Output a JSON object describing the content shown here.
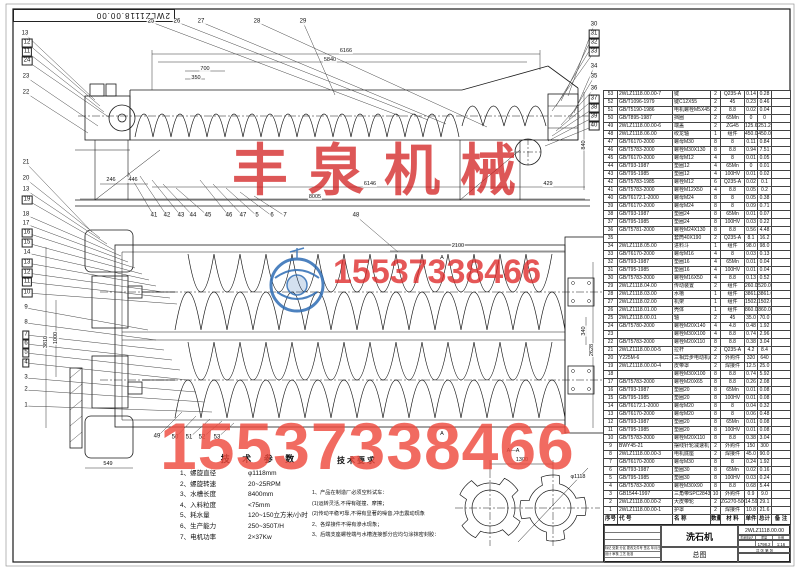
{
  "sheet": {
    "corner_drawing_no": "2WLZ1118.00.00"
  },
  "watermarks": {
    "company": "丰泉机械",
    "phone_mid": "15537338466",
    "phone_large": "15537338466"
  },
  "tech_params": {
    "title": "技 术 参 数",
    "items": [
      [
        "1、螺旋直径",
        "φ1118mm"
      ],
      [
        "2、螺旋转速",
        "20~25RPM"
      ],
      [
        "3、水槽长度",
        "8400mm"
      ],
      [
        "4、入料粒度",
        "<75mm"
      ],
      [
        "5、耗水量",
        "120~150立方米/小时"
      ],
      [
        "6、生产能力",
        "250~350T/H"
      ],
      [
        "7、电机功率",
        "2×37Kw"
      ]
    ]
  },
  "tech_req": {
    "title": "技术要求",
    "lines": [
      "1、产品在制造厂必须空料试车：",
      "(1)运转灵活,不得有碰撞、摩擦；",
      "(2)传动平稳可靠,不得有显著的噪音,冲击震动现象",
      "2、各焊接件不得有渗水现象；",
      "3、后端支座螺栓端与水槽连接部分应均匀涂抹密封胶："
    ]
  },
  "bom": {
    "headers": [
      "序号",
      "代 号",
      "名 称",
      "数量",
      "材 料",
      "单件",
      "总计",
      "备 注"
    ],
    "rows": [
      [
        "53",
        "2WLZ1118.00.00-7",
        "键",
        "2",
        "Q235-A",
        "0.14",
        "0.28",
        ""
      ],
      [
        "52",
        "GB/T1096-1979",
        "键C12X55",
        "2",
        "45",
        "0.23",
        "0.46",
        ""
      ],
      [
        "51",
        "GB/T5190-1986",
        "电机螺栓M5X45",
        "2",
        "8.8",
        "0.02",
        "0.04",
        ""
      ],
      [
        "50",
        "GB/T895-1987",
        "挡圈",
        "2",
        "65Mn",
        "0",
        "0",
        ""
      ],
      [
        "49",
        "2WLZ1118.00.00-6",
        "端盖",
        "2",
        "ZG45",
        "125.6",
        "251.2",
        ""
      ],
      [
        "48",
        "2WLZ1118.06.00",
        "绞龙轴",
        "1",
        "组件",
        "450.0",
        "450.0",
        ""
      ],
      [
        "47",
        "GB/T6170-2000",
        "螺母M30",
        "8",
        "8",
        "0.11",
        "0.84",
        ""
      ],
      [
        "46",
        "GB/T5783-2000",
        "螺栓M30X130",
        "8",
        "8.8",
        "0.94",
        "7.51",
        ""
      ],
      [
        "45",
        "GB/T6170-2000",
        "螺母M12",
        "4",
        "8",
        "0.01",
        "0.05",
        ""
      ],
      [
        "44",
        "GB/T93-1987",
        "垫圈12",
        "4",
        "65Mn",
        "0",
        "0.01",
        ""
      ],
      [
        "43",
        "GB/T95-1985",
        "垫圈12",
        "4",
        "100HV",
        "0.01",
        "0.02",
        ""
      ],
      [
        "42",
        "GB/T5783-1985",
        "螺栓M12",
        "6",
        "Q235-A",
        "0.02",
        "0.1",
        ""
      ],
      [
        "41",
        "GB/T5783-2000",
        "螺栓M12X50",
        "4",
        "8.8",
        "0.05",
        "0.2",
        ""
      ],
      [
        "40",
        "GB/T6172.1-2000",
        "螺母M24",
        "8",
        "8",
        "0.05",
        "0.38",
        ""
      ],
      [
        "39",
        "GB/T6170-2000",
        "螺母M24",
        "8",
        "8",
        "0.09",
        "0.71",
        ""
      ],
      [
        "38",
        "GB/T93-1987",
        "垫圈24",
        "8",
        "65Mn",
        "0.01",
        "0.07",
        ""
      ],
      [
        "37",
        "GB/T95-1985",
        "垫圈24",
        "8",
        "100HV",
        "0.03",
        "0.22",
        ""
      ],
      [
        "36",
        "GB/T5781-2000",
        "螺栓M24X130",
        "8",
        "8.8",
        "0.56",
        "4.48",
        ""
      ],
      [
        "35",
        "",
        "套筒40X190",
        "2",
        "Q235-A",
        "8.1",
        "16.2",
        ""
      ],
      [
        "34",
        "2WLZ1118.05.00",
        "进料斗",
        "1",
        "组件",
        "98.0",
        "98.0",
        ""
      ],
      [
        "33",
        "GB/T6170-2000",
        "螺母M16",
        "4",
        "8",
        "0.03",
        "0.13",
        ""
      ],
      [
        "32",
        "GB/T93-1987",
        "垫圈16",
        "4",
        "65Mn",
        "0.01",
        "0.04",
        ""
      ],
      [
        "31",
        "GB/T95-1985",
        "垫圈16",
        "4",
        "100HV",
        "0.01",
        "0.04",
        ""
      ],
      [
        "30",
        "GB/T5783-2000",
        "螺栓M16X50",
        "4",
        "8.8",
        "0.13",
        "0.52",
        ""
      ],
      [
        "29",
        "2WLZ1118.04.00",
        "传动装置",
        "2",
        "组件",
        "260.0",
        "520.0",
        ""
      ],
      [
        "28",
        "2WLZ1118.03.00",
        "水槽",
        "1",
        "组件",
        "3861.0",
        "3861.0",
        ""
      ],
      [
        "27",
        "2WLZ1118.02.00",
        "机架",
        "1",
        "组件",
        "1502.0",
        "1502.0",
        ""
      ],
      [
        "26",
        "2WLZ1118.01.00",
        "壳体",
        "1",
        "组件",
        "860.0",
        "860.0",
        ""
      ],
      [
        "25",
        "2WLZ1118.00.01",
        "轴",
        "2",
        "45",
        "35.0",
        "70.0",
        ""
      ],
      [
        "24",
        "GB/T5780-2000",
        "螺栓M20X140",
        "4",
        "4.8",
        "0.48",
        "1.92",
        ""
      ],
      [
        "23",
        "",
        "螺栓M30X100",
        "4",
        "8.8",
        "0.74",
        "2.96",
        ""
      ],
      [
        "22",
        "GB/T5783-2000",
        "螺栓M20X110",
        "8",
        "8.8",
        "0.38",
        "3.04",
        ""
      ],
      [
        "21",
        "2WLZ1118.00.00-5",
        "拉杆",
        "2",
        "Q235-A",
        "4.2",
        "8.4",
        ""
      ],
      [
        "20",
        "Y225M-6",
        "三相异步电动机/37KW",
        "2",
        "外购件",
        "320",
        "640",
        ""
      ],
      [
        "19",
        "2WLZ1118.00.00-4",
        "皮带罩",
        "2",
        "焊接件",
        "12.5",
        "25.0",
        ""
      ],
      [
        "18",
        "",
        "螺栓M30X100",
        "8",
        "8.8",
        "0.74",
        "5.92",
        ""
      ],
      [
        "17",
        "GB/T5783-2000",
        "螺栓M20X65",
        "8",
        "8.8",
        "0.26",
        "2.08",
        ""
      ],
      [
        "16",
        "GB/T93-1987",
        "垫圈20",
        "8",
        "65Mn",
        "0.01",
        "0.08",
        ""
      ],
      [
        "15",
        "GB/T95-1985",
        "垫圈20",
        "8",
        "100HV",
        "0.01",
        "0.08",
        ""
      ],
      [
        "14",
        "GB/T6172.1-2000",
        "螺母M20",
        "8",
        "8",
        "0.04",
        "0.32",
        ""
      ],
      [
        "13",
        "GB/T6170-2000",
        "螺母M20",
        "8",
        "8",
        "0.06",
        "0.48",
        ""
      ],
      [
        "12",
        "GB/T93-1987",
        "垫圈20",
        "8",
        "65Mn",
        "0.01",
        "0.08",
        ""
      ],
      [
        "11",
        "GB/T95-1985",
        "垫圈20",
        "8",
        "100HV",
        "0.01",
        "0.08",
        ""
      ],
      [
        "10",
        "GB/T5783-2000",
        "螺栓M20X110",
        "8",
        "8.8",
        "0.38",
        "3.04",
        ""
      ],
      [
        "9",
        "BWY45-21",
        "摆线针轮减速机",
        "2",
        "外购件",
        "150",
        "300",
        ""
      ],
      [
        "8",
        "2WLZ1118.00.00-3",
        "电机底座",
        "2",
        "焊接件",
        "45.0",
        "90.0",
        ""
      ],
      [
        "7",
        "GB/T6170-2000",
        "螺母M30",
        "8",
        "8",
        "0.24",
        "1.92",
        ""
      ],
      [
        "6",
        "GB/T93-1987",
        "垫圈30",
        "8",
        "65Mn",
        "0.02",
        "0.16",
        ""
      ],
      [
        "5",
        "GB/T95-1985",
        "垫圈30",
        "8",
        "100HV",
        "0.03",
        "0.24",
        ""
      ],
      [
        "4",
        "GB/T5783-2000",
        "螺栓M30X90",
        "8",
        "8.8",
        "0.68",
        "5.44",
        ""
      ],
      [
        "3",
        "GB1544-1997",
        "三角带SPC2843",
        "10",
        "外购件",
        "0.9",
        "9.0",
        ""
      ],
      [
        "2",
        "2WLZ1118.00.00-2",
        "大皮带轮",
        "2",
        "ZG270-500",
        "14.59",
        "29.1",
        ""
      ],
      [
        "1",
        "2WLZ1118.00.00-1",
        "护罩",
        "2",
        "焊接件",
        "10.8",
        "21.6",
        ""
      ]
    ]
  },
  "title_block": {
    "product_name": "洗石机",
    "drawing_no": "2WLZ1118.00.00",
    "view_type": "总图",
    "stage_label": "阶段标记",
    "weight_label": "重量",
    "scale_label": "比例",
    "weight_value": "1798.2",
    "scale_value": "1:16",
    "sheet_label": "共 张 第 张",
    "rev_header": "标记 处数 分区 更改文件号 签名 年月日",
    "sign_row": "设计  审核  工艺  批准"
  },
  "callouts": [
    [
      "13",
      25,
      34,
      0,
      95,
      100
    ],
    [
      "12",
      27,
      43,
      1,
      100,
      106
    ],
    [
      "11",
      27,
      52,
      1,
      104,
      112
    ],
    [
      "24",
      27,
      61,
      1,
      110,
      118
    ],
    [
      "23",
      26,
      77,
      0,
      98,
      126
    ],
    [
      "22",
      26,
      93,
      0,
      88,
      133
    ],
    [
      "25",
      151,
      22,
      0,
      400,
      116
    ],
    [
      "26",
      177,
      22,
      0,
      428,
      120
    ],
    [
      "27",
      201,
      22,
      0,
      446,
      124
    ],
    [
      "28",
      257,
      22,
      0,
      487,
      127
    ],
    [
      "29",
      303,
      22,
      0,
      335,
      95
    ],
    [
      "30",
      594,
      25,
      0,
      568,
      96
    ],
    [
      "31",
      594,
      34,
      1,
      561,
      101
    ],
    [
      "32",
      594,
      43,
      1,
      556,
      106
    ],
    [
      "33",
      594,
      52,
      1,
      552,
      111
    ],
    [
      "34",
      594,
      67,
      0,
      574,
      113
    ],
    [
      "35",
      594,
      77,
      0,
      569,
      119
    ],
    [
      "36",
      594,
      89,
      0,
      561,
      125
    ],
    [
      "37",
      594,
      99,
      1,
      556,
      131
    ],
    [
      "38",
      594,
      108,
      1,
      552,
      136
    ],
    [
      "39",
      594,
      117,
      1,
      548,
      141
    ],
    [
      "40",
      594,
      126,
      1,
      545,
      146
    ],
    [
      "41",
      154,
      216,
      0,
      128,
      172
    ],
    [
      "42",
      167,
      216,
      0,
      140,
      176
    ],
    [
      "43",
      181,
      216,
      0,
      152,
      180
    ],
    [
      "44",
      193,
      216,
      0,
      163,
      184
    ],
    [
      "45",
      208,
      216,
      0,
      176,
      188
    ],
    [
      "46",
      229,
      216,
      0,
      200,
      180
    ],
    [
      "47",
      243,
      216,
      0,
      213,
      184
    ],
    [
      "5",
      257,
      216,
      0,
      226,
      188
    ],
    [
      "6",
      272,
      216,
      0,
      240,
      192
    ],
    [
      "7",
      285,
      216,
      0,
      254,
      196
    ],
    [
      "48",
      356,
      216,
      0,
      398,
      252
    ],
    [
      "21",
      26,
      163,
      0,
      92,
      232
    ],
    [
      "20",
      26,
      179,
      0,
      100,
      238
    ],
    [
      "13",
      26,
      190,
      0,
      107,
      244
    ],
    [
      "19",
      27,
      200,
      1,
      114,
      250
    ],
    [
      "18",
      26,
      215,
      0,
      121,
      256
    ],
    [
      "17",
      26,
      224,
      0,
      128,
      262
    ],
    [
      "16",
      27,
      233,
      1,
      135,
      268
    ],
    [
      "15",
      27,
      243,
      1,
      142,
      274
    ],
    [
      "14",
      27,
      253,
      0,
      149,
      280
    ],
    [
      "13",
      27,
      263,
      1,
      156,
      286
    ],
    [
      "12",
      27,
      273,
      1,
      163,
      292
    ],
    [
      "11",
      27,
      282,
      1,
      170,
      298
    ],
    [
      "10",
      27,
      293,
      1,
      177,
      304
    ],
    [
      "9",
      26,
      308,
      0,
      148,
      330
    ],
    [
      "8",
      26,
      323,
      0,
      156,
      340
    ],
    [
      "7",
      26,
      335,
      1,
      164,
      350
    ],
    [
      "6",
      26,
      344,
      1,
      172,
      360
    ],
    [
      "5",
      26,
      353,
      1,
      180,
      370
    ],
    [
      "4",
      26,
      363,
      1,
      188,
      380
    ],
    [
      "3",
      26,
      378,
      0,
      196,
      392
    ],
    [
      "2",
      26,
      390,
      0,
      204,
      402
    ],
    [
      "1",
      26,
      406,
      0,
      212,
      412
    ],
    [
      "49",
      157,
      437,
      0,
      182,
      412
    ],
    [
      "50",
      175,
      438,
      0,
      196,
      416
    ],
    [
      "51",
      189,
      438,
      0,
      210,
      419
    ],
    [
      "52",
      202,
      438,
      0,
      222,
      421
    ],
    [
      "53",
      217,
      438,
      0,
      234,
      423
    ]
  ],
  "dim_labels": [
    [
      "6166",
      346,
      51,
      0
    ],
    [
      "5840",
      330,
      60,
      0
    ],
    [
      "700",
      205,
      69,
      0
    ],
    [
      "350",
      196,
      78,
      0
    ],
    [
      "246",
      111,
      180,
      0
    ],
    [
      "446",
      133,
      180,
      0
    ],
    [
      "6146",
      370,
      184,
      0
    ],
    [
      "429",
      548,
      184,
      0
    ],
    [
      "8005",
      315,
      197,
      0
    ],
    [
      "840",
      584,
      145,
      90
    ],
    [
      "2100",
      458,
      246,
      0
    ],
    [
      "A",
      442,
      258,
      0
    ],
    [
      "A",
      442,
      434,
      0
    ],
    [
      "340",
      584,
      331,
      90
    ],
    [
      "2628",
      592,
      350,
      90
    ],
    [
      "1000",
      56,
      338,
      90
    ],
    [
      "3810",
      46,
      342,
      90
    ],
    [
      "549",
      108,
      464,
      0
    ],
    [
      "A—A",
      513,
      451,
      0
    ],
    [
      "1300",
      522,
      460,
      0
    ],
    [
      "φ1118",
      578,
      477,
      0
    ]
  ]
}
